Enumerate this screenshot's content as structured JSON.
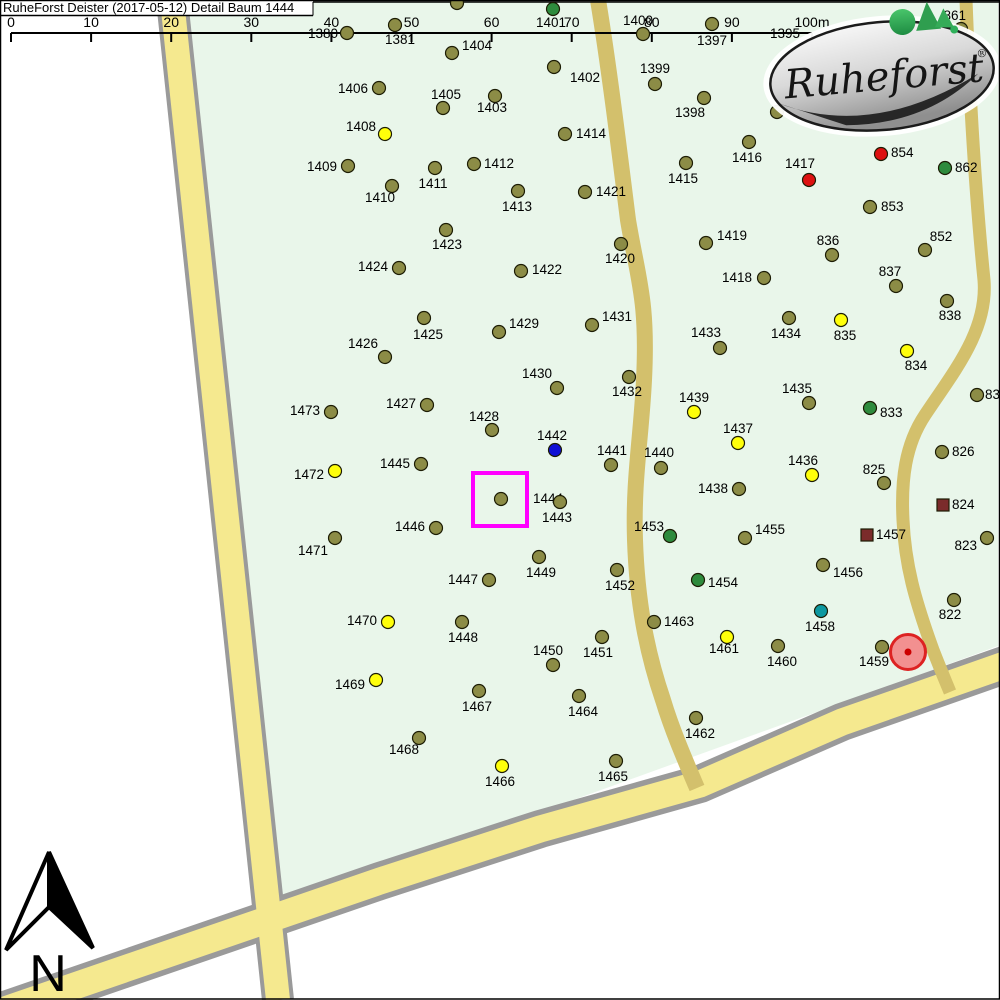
{
  "title": "RuheForst Deister (2017-05-12) Detail  Baum 1444",
  "north": {
    "label": "N"
  },
  "logo": {
    "text": "Ruheforst",
    "reg": "®"
  },
  "scale_bar": {
    "ticks": [
      "0",
      "10",
      "20",
      "30",
      "40",
      "50",
      "60",
      "70",
      "80",
      "90",
      "100m"
    ],
    "x0": 11,
    "dx": 80.1,
    "y_line": 33,
    "tick_len": 9,
    "label_baseline": 27,
    "x_end": 812
  },
  "colors": {
    "map_background": "#e9f6ea",
    "road_light": "#f5e98f",
    "road_dark": "#d3c06c",
    "road_border": "#9a9a9a",
    "highlight_box": "#ff00ff",
    "grave_fill": "#f29090",
    "grave_border": "#dd2222",
    "markers": {
      "o": "#8c8c46",
      "y": "#ffff0a",
      "r": "#dd1111",
      "g": "#2e8b3d",
      "b": "#0f0fd6",
      "t": "#0d98a0",
      "s": "#7b2b2b",
      "none": "none"
    }
  },
  "highlight": {
    "tree": "1444",
    "x": 473,
    "y": 473,
    "w": 54,
    "h": 53,
    "stroke_width": 4
  },
  "grave_marker": {
    "x": 908,
    "y": 652,
    "r": 17.5,
    "dot_r": 3.5
  },
  "trees": [
    {
      "n": "1380",
      "x": 347,
      "y": 33,
      "c": "o",
      "lx": 338,
      "ly": 38,
      "a": "e"
    },
    {
      "n": "1381",
      "x": 395,
      "y": 25,
      "c": "o",
      "lx": 400,
      "ly": 44,
      "a": "m"
    },
    {
      "n": "1404",
      "x": 452,
      "y": 53,
      "c": "o",
      "lx": 462,
      "ly": 50,
      "a": "s"
    },
    {
      "n": "",
      "x": 457,
      "y": 3,
      "c": "o"
    },
    {
      "n": "1401",
      "x": 553,
      "y": 9,
      "c": "g",
      "lx": 551,
      "ly": 27,
      "a": "m"
    },
    {
      "n": "1400",
      "x": 643,
      "y": 34,
      "c": "o",
      "lx": 638,
      "ly": 25,
      "a": "m"
    },
    {
      "n": "1397",
      "x": 712,
      "y": 24,
      "c": "o",
      "lx": 712,
      "ly": 45,
      "a": "m"
    },
    {
      "n": "1395",
      "c": "none",
      "lx": 785,
      "ly": 38,
      "a": "m"
    },
    {
      "n": "861",
      "x": 961,
      "y": 29,
      "c": "o",
      "lx": 966,
      "ly": 20,
      "a": "e"
    },
    {
      "n": "1399",
      "x": 655,
      "y": 84,
      "c": "o",
      "lx": 655,
      "ly": 73,
      "a": "m"
    },
    {
      "n": "1402",
      "x": 554,
      "y": 67,
      "c": "o",
      "lx": 570,
      "ly": 82,
      "a": "s"
    },
    {
      "n": "1398",
      "x": 704,
      "y": 98,
      "c": "o",
      "lx": 690,
      "ly": 117,
      "a": "m"
    },
    {
      "n": "1406",
      "x": 379,
      "y": 88,
      "c": "o",
      "lx": 368,
      "ly": 93,
      "a": "e"
    },
    {
      "n": "1405",
      "x": 443,
      "y": 108,
      "c": "o",
      "lx": 446,
      "ly": 99,
      "a": "m"
    },
    {
      "n": "1403",
      "x": 495,
      "y": 96,
      "c": "o",
      "lx": 492,
      "ly": 112,
      "a": "m"
    },
    {
      "n": "1414",
      "x": 565,
      "y": 134,
      "c": "o",
      "lx": 576,
      "ly": 138,
      "a": "s"
    },
    {
      "n": "1408",
      "x": 385,
      "y": 134,
      "c": "y",
      "lx": 376,
      "ly": 131,
      "a": "e"
    },
    {
      "n": "",
      "x": 777,
      "y": 112,
      "c": "o"
    },
    {
      "n": "1416",
      "x": 749,
      "y": 142,
      "c": "o",
      "lx": 747,
      "ly": 162,
      "a": "m"
    },
    {
      "n": "854",
      "x": 881,
      "y": 154,
      "c": "r",
      "lx": 891,
      "ly": 157,
      "a": "s"
    },
    {
      "n": "862",
      "x": 945,
      "y": 168,
      "c": "g",
      "lx": 955,
      "ly": 172,
      "a": "s"
    },
    {
      "n": "1417",
      "x": 809,
      "y": 180,
      "c": "r",
      "lx": 800,
      "ly": 168,
      "a": "m"
    },
    {
      "n": "1415",
      "x": 686,
      "y": 163,
      "c": "o",
      "lx": 683,
      "ly": 183,
      "a": "m"
    },
    {
      "n": "1409",
      "x": 348,
      "y": 166,
      "c": "o",
      "lx": 337,
      "ly": 171,
      "a": "e"
    },
    {
      "n": "1412",
      "x": 474,
      "y": 164,
      "c": "o",
      "lx": 484,
      "ly": 168,
      "a": "s"
    },
    {
      "n": "1411",
      "x": 435,
      "y": 168,
      "c": "o",
      "lx": 433,
      "ly": 188,
      "a": "m"
    },
    {
      "n": "1410",
      "x": 392,
      "y": 186,
      "c": "o",
      "lx": 380,
      "ly": 202,
      "a": "m"
    },
    {
      "n": "853",
      "x": 870,
      "y": 207,
      "c": "o",
      "lx": 881,
      "ly": 211,
      "a": "s"
    },
    {
      "n": "1413",
      "x": 518,
      "y": 191,
      "c": "o",
      "lx": 517,
      "ly": 211,
      "a": "m"
    },
    {
      "n": "1421",
      "x": 585,
      "y": 192,
      "c": "o",
      "lx": 596,
      "ly": 196,
      "a": "s"
    },
    {
      "n": "1423",
      "x": 446,
      "y": 230,
      "c": "o",
      "lx": 447,
      "ly": 249,
      "a": "m"
    },
    {
      "n": "1419",
      "x": 706,
      "y": 243,
      "c": "o",
      "lx": 717,
      "ly": 240,
      "a": "s"
    },
    {
      "n": "836",
      "x": 832,
      "y": 255,
      "c": "o",
      "lx": 828,
      "ly": 245,
      "a": "m"
    },
    {
      "n": "852",
      "x": 925,
      "y": 250,
      "c": "o",
      "lx": 941,
      "ly": 241,
      "a": "m"
    },
    {
      "n": "1424",
      "x": 399,
      "y": 268,
      "c": "o",
      "lx": 388,
      "ly": 271,
      "a": "e"
    },
    {
      "n": "1422",
      "x": 521,
      "y": 271,
      "c": "o",
      "lx": 532,
      "ly": 274,
      "a": "s"
    },
    {
      "n": "1420",
      "x": 621,
      "y": 244,
      "c": "o",
      "lx": 620,
      "ly": 263,
      "a": "m"
    },
    {
      "n": "1418",
      "x": 764,
      "y": 278,
      "c": "o",
      "lx": 752,
      "ly": 282,
      "a": "e"
    },
    {
      "n": "837",
      "x": 896,
      "y": 286,
      "c": "o",
      "lx": 890,
      "ly": 276,
      "a": "m"
    },
    {
      "n": "838",
      "x": 947,
      "y": 301,
      "c": "o",
      "lx": 950,
      "ly": 320,
      "a": "m"
    },
    {
      "n": "1425",
      "x": 424,
      "y": 318,
      "c": "o",
      "lx": 428,
      "ly": 339,
      "a": "m"
    },
    {
      "n": "1429",
      "x": 499,
      "y": 332,
      "c": "o",
      "lx": 509,
      "ly": 328,
      "a": "s"
    },
    {
      "n": "1431",
      "x": 592,
      "y": 325,
      "c": "o",
      "lx": 602,
      "ly": 321,
      "a": "s"
    },
    {
      "n": "1433",
      "x": 720,
      "y": 348,
      "c": "o",
      "lx": 706,
      "ly": 337,
      "a": "m"
    },
    {
      "n": "1434",
      "x": 789,
      "y": 318,
      "c": "o",
      "lx": 786,
      "ly": 338,
      "a": "m"
    },
    {
      "n": "835",
      "x": 841,
      "y": 320,
      "c": "y",
      "lx": 845,
      "ly": 340,
      "a": "m"
    },
    {
      "n": "1426",
      "x": 385,
      "y": 357,
      "c": "o",
      "lx": 363,
      "ly": 348,
      "a": "m"
    },
    {
      "n": "834",
      "x": 907,
      "y": 351,
      "c": "y",
      "lx": 916,
      "ly": 370,
      "a": "m"
    },
    {
      "n": "1430",
      "x": 557,
      "y": 388,
      "c": "o",
      "lx": 537,
      "ly": 378,
      "a": "m"
    },
    {
      "n": "1432",
      "x": 629,
      "y": 377,
      "c": "o",
      "lx": 627,
      "ly": 396,
      "a": "m"
    },
    {
      "n": "832",
      "x": 977,
      "y": 395,
      "c": "o",
      "lx": 985,
      "ly": 399,
      "a": "s"
    },
    {
      "n": "1439",
      "x": 694,
      "y": 412,
      "c": "y",
      "lx": 694,
      "ly": 402,
      "a": "m"
    },
    {
      "n": "1435",
      "x": 809,
      "y": 403,
      "c": "o",
      "lx": 797,
      "ly": 393,
      "a": "m"
    },
    {
      "n": "833",
      "x": 870,
      "y": 408,
      "c": "g",
      "lx": 880,
      "ly": 417,
      "a": "s"
    },
    {
      "n": "1473",
      "x": 331,
      "y": 412,
      "c": "o",
      "lx": 320,
      "ly": 415,
      "a": "e"
    },
    {
      "n": "1427",
      "x": 427,
      "y": 405,
      "c": "o",
      "lx": 416,
      "ly": 408,
      "a": "e"
    },
    {
      "n": "1428",
      "x": 492,
      "y": 430,
      "c": "o",
      "lx": 484,
      "ly": 421,
      "a": "m"
    },
    {
      "n": "1437",
      "x": 738,
      "y": 443,
      "c": "y",
      "lx": 738,
      "ly": 433,
      "a": "m"
    },
    {
      "n": "1442",
      "x": 555,
      "y": 450,
      "c": "b",
      "lx": 552,
      "ly": 440,
      "a": "m"
    },
    {
      "n": "1441",
      "x": 611,
      "y": 465,
      "c": "o",
      "lx": 612,
      "ly": 455,
      "a": "m"
    },
    {
      "n": "826",
      "x": 942,
      "y": 452,
      "c": "o",
      "lx": 952,
      "ly": 456,
      "a": "s"
    },
    {
      "n": "1440",
      "x": 661,
      "y": 468,
      "c": "o",
      "lx": 659,
      "ly": 457,
      "a": "m"
    },
    {
      "n": "1436",
      "x": 812,
      "y": 475,
      "c": "y",
      "lx": 803,
      "ly": 465,
      "a": "m"
    },
    {
      "n": "825",
      "x": 884,
      "y": 483,
      "c": "o",
      "lx": 874,
      "ly": 474,
      "a": "m"
    },
    {
      "n": "1472",
      "x": 335,
      "y": 471,
      "c": "y",
      "lx": 324,
      "ly": 479,
      "a": "e"
    },
    {
      "n": "1445",
      "x": 421,
      "y": 464,
      "c": "o",
      "lx": 410,
      "ly": 468,
      "a": "e"
    },
    {
      "n": "1444",
      "x": 501,
      "y": 499,
      "c": "o",
      "lx": 533,
      "ly": 503,
      "a": "s"
    },
    {
      "n": "1443",
      "x": 560,
      "y": 502,
      "c": "o",
      "lx": 557,
      "ly": 522,
      "a": "m"
    },
    {
      "n": "1438",
      "x": 739,
      "y": 489,
      "c": "o",
      "lx": 728,
      "ly": 493,
      "a": "e"
    },
    {
      "n": "824",
      "x": 943,
      "y": 505,
      "c": "s",
      "lx": 952,
      "ly": 509,
      "a": "s"
    },
    {
      "n": "1446",
      "x": 436,
      "y": 528,
      "c": "o",
      "lx": 425,
      "ly": 531,
      "a": "e"
    },
    {
      "n": "1453",
      "x": 670,
      "y": 536,
      "c": "g",
      "lx": 664,
      "ly": 531,
      "a": "e"
    },
    {
      "n": "1455",
      "x": 745,
      "y": 538,
      "c": "o",
      "lx": 755,
      "ly": 534,
      "a": "s"
    },
    {
      "n": "1457",
      "x": 867,
      "y": 535,
      "c": "s",
      "lx": 876,
      "ly": 539,
      "a": "s"
    },
    {
      "n": "823",
      "x": 987,
      "y": 538,
      "c": "o",
      "lx": 977,
      "ly": 550,
      "a": "e"
    },
    {
      "n": "1471",
      "x": 335,
      "y": 538,
      "c": "o",
      "lx": 313,
      "ly": 555,
      "a": "m"
    },
    {
      "n": "1449",
      "x": 539,
      "y": 557,
      "c": "o",
      "lx": 541,
      "ly": 577,
      "a": "m"
    },
    {
      "n": "1456",
      "x": 823,
      "y": 565,
      "c": "o",
      "lx": 833,
      "ly": 577,
      "a": "s"
    },
    {
      "n": "1452",
      "x": 617,
      "y": 570,
      "c": "o",
      "lx": 620,
      "ly": 590,
      "a": "m"
    },
    {
      "n": "1447",
      "x": 489,
      "y": 580,
      "c": "o",
      "lx": 478,
      "ly": 584,
      "a": "e"
    },
    {
      "n": "1454",
      "x": 698,
      "y": 580,
      "c": "g",
      "lx": 708,
      "ly": 587,
      "a": "s"
    },
    {
      "n": "822",
      "x": 954,
      "y": 600,
      "c": "o",
      "lx": 950,
      "ly": 619,
      "a": "m"
    },
    {
      "n": "1458",
      "x": 821,
      "y": 611,
      "c": "t",
      "lx": 820,
      "ly": 631,
      "a": "m"
    },
    {
      "n": "1470",
      "x": 388,
      "y": 622,
      "c": "y",
      "lx": 377,
      "ly": 625,
      "a": "e"
    },
    {
      "n": "1448",
      "x": 462,
      "y": 622,
      "c": "o",
      "lx": 463,
      "ly": 642,
      "a": "m"
    },
    {
      "n": "1463",
      "x": 654,
      "y": 622,
      "c": "o",
      "lx": 664,
      "ly": 626,
      "a": "s"
    },
    {
      "n": "1451",
      "x": 602,
      "y": 637,
      "c": "o",
      "lx": 598,
      "ly": 657,
      "a": "m"
    },
    {
      "n": "1461",
      "x": 727,
      "y": 637,
      "c": "y",
      "lx": 724,
      "ly": 653,
      "a": "m"
    },
    {
      "n": "1450",
      "x": 553,
      "y": 665,
      "c": "o",
      "lx": 548,
      "ly": 655,
      "a": "m"
    },
    {
      "n": "1460",
      "x": 778,
      "y": 646,
      "c": "o",
      "lx": 782,
      "ly": 666,
      "a": "m"
    },
    {
      "n": "1459",
      "x": 882,
      "y": 647,
      "c": "o",
      "lx": 874,
      "ly": 666,
      "a": "m"
    },
    {
      "n": "1469",
      "x": 376,
      "y": 680,
      "c": "y",
      "lx": 365,
      "ly": 689,
      "a": "e"
    },
    {
      "n": "1467",
      "x": 479,
      "y": 691,
      "c": "o",
      "lx": 477,
      "ly": 711,
      "a": "m"
    },
    {
      "n": "1464",
      "x": 579,
      "y": 696,
      "c": "o",
      "lx": 583,
      "ly": 716,
      "a": "m"
    },
    {
      "n": "1462",
      "x": 696,
      "y": 718,
      "c": "o",
      "lx": 700,
      "ly": 738,
      "a": "m"
    },
    {
      "n": "1468",
      "x": 419,
      "y": 738,
      "c": "o",
      "lx": 404,
      "ly": 754,
      "a": "m"
    },
    {
      "n": "1466",
      "x": 502,
      "y": 766,
      "c": "y",
      "lx": 500,
      "ly": 786,
      "a": "m"
    },
    {
      "n": "1465",
      "x": 616,
      "y": 761,
      "c": "o",
      "lx": 613,
      "ly": 781,
      "a": "m"
    }
  ]
}
